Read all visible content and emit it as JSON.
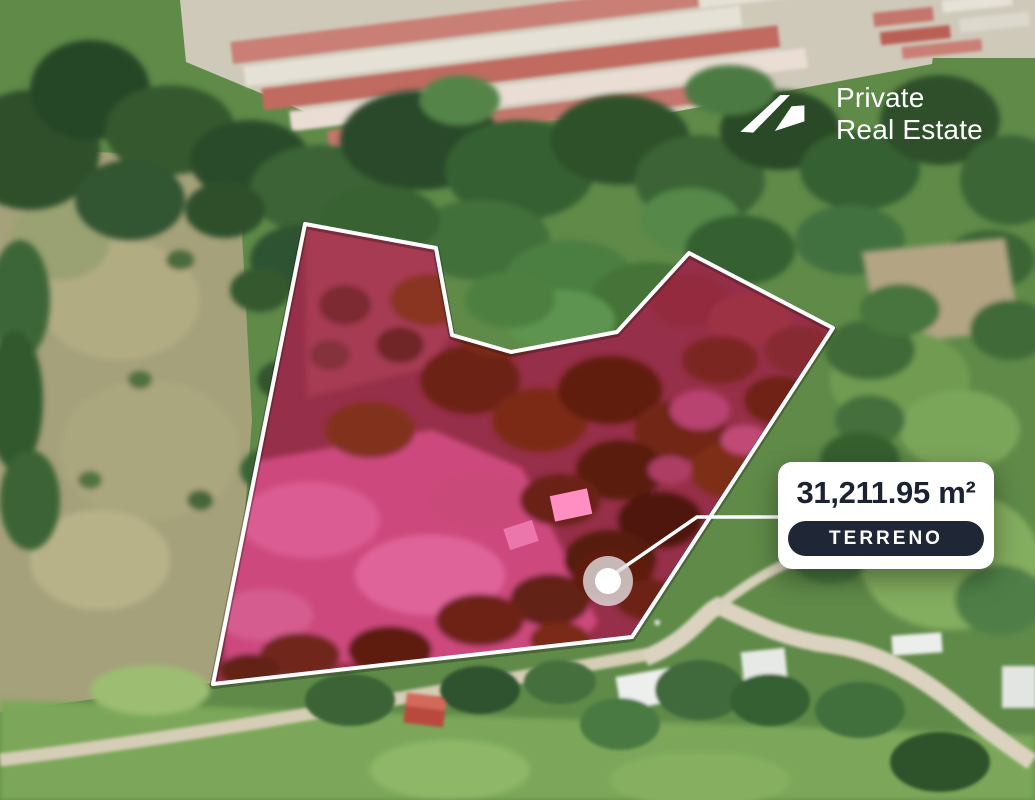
{
  "brand": {
    "line1": "Private",
    "line2": "Real Estate",
    "logo_icon": "house-roof-icon",
    "text_color": "#ffffff"
  },
  "parcel_label": {
    "area": "31,211.95 m²",
    "badge": "TERRENO"
  },
  "icons": {
    "logo": "house-roof-icon",
    "marker": "location-marker-icon"
  },
  "colors": {
    "parcel_overlay": "#c22a50",
    "parcel_meadow_pink": "#cd4a7d",
    "parcel_trees_maroon": "#6d2315",
    "boundary_line": "#ffffff",
    "leader_line": "#ffffff",
    "card_background": "#ffffff",
    "card_text": "#1b2231",
    "badge_background": "#1f2636",
    "badge_text": "#ffffff",
    "forest_green": "#2e4f2b",
    "field_olive": "#a5a17a",
    "road_tan": "#d9d2c0"
  }
}
